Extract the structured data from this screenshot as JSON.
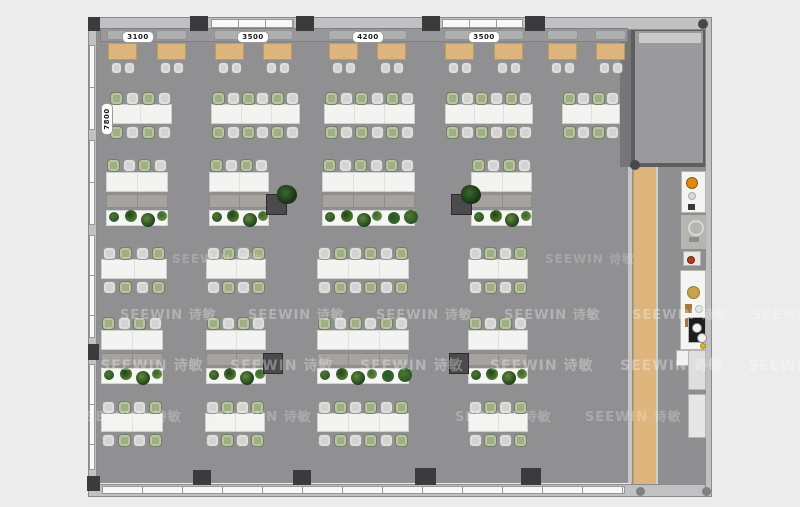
{
  "labels": {
    "top": [
      {
        "text": "3100",
        "cx": 137
      },
      {
        "text": "3500",
        "cx": 252
      },
      {
        "text": "4200",
        "cx": 367
      },
      {
        "text": "3500",
        "cx": 483
      }
    ],
    "left": {
      "text": "7800",
      "cx": 106,
      "cy": 118
    }
  },
  "watermark": {
    "text": "SEEWIN 诗敏",
    "rows": [
      {
        "y": 250,
        "xs": [
          172,
          545
        ],
        "size": 12,
        "op": 0.2
      },
      {
        "y": 304,
        "xs": [
          120,
          248,
          376,
          504,
          632,
          752
        ],
        "size": 13,
        "op": 0.3
      },
      {
        "y": 355,
        "xs": [
          100,
          230,
          360,
          490,
          620,
          748
        ],
        "size": 14,
        "op": 0.32
      },
      {
        "y": 406,
        "xs": [
          85,
          215,
          455,
          585
        ],
        "size": 13,
        "op": 0.24
      }
    ]
  },
  "scene": {
    "colors": {
      "chairGreen": "#9fae83",
      "chairGray": "#d3d3d1",
      "woodTop": "#ddb57d",
      "tableWhite": "#f3f3f1",
      "storage": "#a6a39e",
      "cabinetDark": "#4b4b4d",
      "plantPalette": [
        "#2c5526",
        "#4d7a32",
        "#1f421c",
        "#628a3e",
        "#3a652e"
      ]
    },
    "booths": {
      "sofa": {
        "x": 100,
        "y": 28,
        "w": 528,
        "h": 14
      },
      "tableXs": [
        108,
        157,
        215,
        263,
        329,
        377,
        445,
        494,
        548,
        596
      ],
      "tableY": 43,
      "tableW": 29,
      "tableH": 17,
      "chairY": 62
    },
    "deskRows": [
      {
        "kind": "double",
        "startGreen": true,
        "chairTop": 92,
        "tableY": 104,
        "tableH": 20,
        "chairBottom": 126,
        "groups": [
          {
            "x": 108,
            "w": 64,
            "n": 4
          },
          {
            "x": 211,
            "w": 89,
            "n": 6
          },
          {
            "x": 324,
            "w": 91,
            "n": 6
          },
          {
            "x": 445,
            "w": 88,
            "n": 6
          },
          {
            "x": 562,
            "w": 58,
            "n": 4
          }
        ]
      },
      {
        "kind": "storage",
        "startGreen": true,
        "chairTop": 159,
        "tableY": 172,
        "tableH": 20,
        "storageY": 194,
        "storageH": 14,
        "planterY": 210,
        "planterH": 16,
        "groups": [
          {
            "x": 106,
            "w": 62,
            "n": 4
          },
          {
            "x": 209,
            "w": 60,
            "n": 4
          },
          {
            "x": 322,
            "w": 93,
            "n": 6
          },
          {
            "x": 471,
            "w": 61,
            "n": 4
          }
        ]
      },
      {
        "kind": "double",
        "startGreen": false,
        "chairTop": 247,
        "tableY": 259,
        "tableH": 20,
        "chairBottom": 281,
        "groups": [
          {
            "x": 101,
            "w": 66,
            "n": 4
          },
          {
            "x": 206,
            "w": 60,
            "n": 4
          },
          {
            "x": 317,
            "w": 92,
            "n": 6
          },
          {
            "x": 468,
            "w": 60,
            "n": 4
          }
        ]
      },
      {
        "kind": "storage",
        "startGreen": true,
        "chairTop": 317,
        "tableY": 330,
        "tableH": 20,
        "storageY": 353,
        "storageH": 13,
        "planterY": 368,
        "planterH": 16,
        "groups": [
          {
            "x": 101,
            "w": 62,
            "n": 4
          },
          {
            "x": 206,
            "w": 60,
            "n": 4
          },
          {
            "x": 317,
            "w": 92,
            "n": 6
          },
          {
            "x": 468,
            "w": 60,
            "n": 4
          }
        ]
      },
      {
        "kind": "double",
        "startGreen": false,
        "chairTop": 401,
        "tableY": 413,
        "tableH": 19,
        "chairBottom": 434,
        "groups": [
          {
            "x": 101,
            "w": 62,
            "n": 4
          },
          {
            "x": 205,
            "w": 60,
            "n": 4
          },
          {
            "x": 317,
            "w": 92,
            "n": 6
          },
          {
            "x": 468,
            "w": 60,
            "n": 4
          }
        ]
      }
    ],
    "cabinets": [
      {
        "x": 266,
        "y": 194,
        "w": 21,
        "h": 21
      },
      {
        "x": 451,
        "y": 194,
        "w": 21,
        "h": 21
      },
      {
        "x": 263,
        "y": 353,
        "w": 20,
        "h": 21
      },
      {
        "x": 449,
        "y": 353,
        "w": 20,
        "h": 21
      }
    ],
    "freePlants": [
      {
        "x": 277,
        "y": 185
      },
      {
        "x": 461,
        "y": 185
      }
    ],
    "columns": [
      {
        "x": 88,
        "y": 17,
        "w": 12,
        "h": 14
      },
      {
        "x": 190,
        "y": 16,
        "w": 18,
        "h": 15
      },
      {
        "x": 296,
        "y": 16,
        "w": 18,
        "h": 15
      },
      {
        "x": 422,
        "y": 16,
        "w": 18,
        "h": 15
      },
      {
        "x": 525,
        "y": 16,
        "w": 20,
        "h": 15
      },
      {
        "x": 88,
        "y": 344,
        "w": 11,
        "h": 16
      },
      {
        "x": 87,
        "y": 476,
        "w": 13,
        "h": 15
      },
      {
        "x": 193,
        "y": 470,
        "w": 18,
        "h": 15
      },
      {
        "x": 293,
        "y": 470,
        "w": 18,
        "h": 15
      },
      {
        "x": 415,
        "y": 468,
        "w": 21,
        "h": 17
      },
      {
        "x": 521,
        "y": 468,
        "w": 20,
        "h": 17
      }
    ],
    "windows": [
      {
        "x": 211,
        "y": 19,
        "w": 83,
        "h": 9,
        "v": false,
        "pane": 27
      },
      {
        "x": 442,
        "y": 19,
        "w": 81,
        "h": 9,
        "v": false,
        "pane": 27
      },
      {
        "x": 89,
        "y": 45,
        "w": 6,
        "h": 85,
        "v": true,
        "pane": 42
      },
      {
        "x": 89,
        "y": 140,
        "w": 6,
        "h": 85,
        "v": true,
        "pane": 42
      },
      {
        "x": 89,
        "y": 235,
        "w": 6,
        "h": 103,
        "v": true,
        "pane": 40
      },
      {
        "x": 89,
        "y": 364,
        "w": 6,
        "h": 106,
        "v": true,
        "pane": 40
      },
      {
        "x": 102,
        "y": 486,
        "w": 523,
        "h": 8,
        "v": false,
        "pane": 40
      }
    ],
    "dots": [
      {
        "x": 698,
        "y": 19,
        "d": 10,
        "c": "#48484a"
      },
      {
        "x": 630,
        "y": 160,
        "d": 10,
        "c": "#48484a"
      },
      {
        "x": 636,
        "y": 487,
        "d": 9,
        "c": "#808083"
      },
      {
        "x": 702,
        "y": 487,
        "d": 9,
        "c": "#808083"
      }
    ],
    "appliances": [
      {
        "x": 681,
        "y": 171,
        "w": 25,
        "h": 42,
        "bg": "#f4f4f2",
        "items": [
          {
            "t": "c",
            "x": 9,
            "y": 10,
            "d": 10,
            "c": "#e08a14",
            "b": "#8a5a10"
          },
          {
            "t": "c",
            "x": 9,
            "y": 23,
            "d": 6,
            "c": "#d8d8d6",
            "b": "#aaa"
          },
          {
            "t": "r",
            "x": 6,
            "y": 32,
            "w": 7,
            "h": 6,
            "c": "#3a3a3c"
          }
        ]
      },
      {
        "x": 681,
        "y": 215,
        "w": 25,
        "h": 34,
        "bg": "#b7b5b2",
        "items": [
          {
            "t": "o",
            "x": 12,
            "y": 10,
            "d": 12,
            "c": "#d8d8d6"
          },
          {
            "t": "r",
            "x": 7,
            "y": 21,
            "w": 10,
            "h": 5,
            "c": "#8f8d8a"
          }
        ]
      },
      {
        "x": 683,
        "y": 251,
        "w": 18,
        "h": 15,
        "bg": "#e8e8e6",
        "items": [
          {
            "t": "c",
            "x": 6,
            "y": 7,
            "d": 6,
            "c": "#b04020",
            "b": "#702010"
          }
        ]
      },
      {
        "x": 680,
        "y": 270,
        "w": 26,
        "h": 80,
        "bg": "#f4f4f2",
        "items": [
          {
            "t": "c",
            "x": 11,
            "y": 20,
            "d": 11,
            "c": "#c9a24a",
            "b": "#9a7830"
          },
          {
            "t": "r",
            "x": 4,
            "y": 33,
            "w": 7,
            "h": 9,
            "c": "#a4793f"
          },
          {
            "t": "c",
            "x": 17,
            "y": 37,
            "d": 6,
            "c": "#e8e8e6",
            "b": "#bbb"
          },
          {
            "t": "r",
            "x": 4,
            "y": 47,
            "w": 7,
            "h": 9,
            "c": "#a4793f"
          },
          {
            "t": "c",
            "x": 17,
            "y": 51,
            "d": 6,
            "c": "#e8e8e6",
            "b": "#bbb"
          },
          {
            "t": "c",
            "x": 21,
            "y": 74,
            "d": 4,
            "c": "#e2b820",
            "b": "#a88410"
          }
        ]
      },
      {
        "x": 688,
        "y": 317,
        "w": 18,
        "h": 26,
        "bg": "#1d1d1f",
        "items": [
          {
            "t": "c",
            "x": 7,
            "y": 9,
            "d": 8,
            "c": "#f4f4f2",
            "b": "#888"
          },
          {
            "t": "c",
            "x": 12,
            "y": 19,
            "d": 8,
            "c": "#f4f4f2",
            "b": "#888"
          }
        ]
      },
      {
        "x": 676,
        "y": 350,
        "w": 14,
        "h": 16,
        "bg": "#f0f0ee",
        "items": []
      },
      {
        "x": 688,
        "y": 350,
        "w": 18,
        "h": 40,
        "bg": "#dededc",
        "items": []
      },
      {
        "x": 688,
        "y": 394,
        "w": 18,
        "h": 44,
        "bg": "#e6e6e4",
        "items": []
      }
    ]
  }
}
